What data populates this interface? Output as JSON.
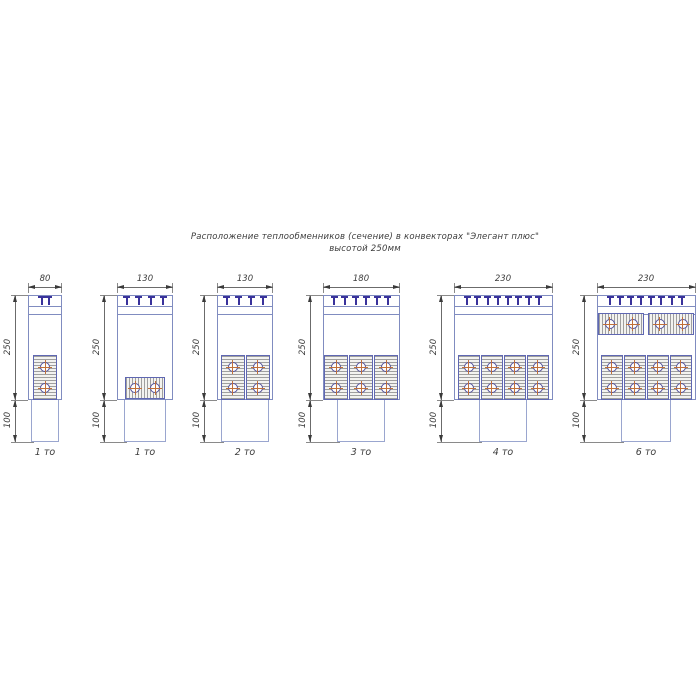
{
  "title": {
    "line1": "Расположение теплообменников (сечение) в конвекторах \"Элегант плюс\"",
    "line2": "высотой 250мм"
  },
  "units": "мм",
  "colors": {
    "outline_blue": "#808cc0",
    "grille_navy": "#39329b",
    "block_border": "#5f67b2",
    "hatch_gray": "#9f9f9f",
    "tube_ring": "#53519c",
    "tube_crosshair": "#c0703a",
    "dimension_text": "#3d3d3d"
  },
  "diagrams": [
    {
      "dim_width": "80",
      "dim_height": "250",
      "dim_duct_height": "100",
      "label": "1 то",
      "grille_slats": 2,
      "heat_exchangers": {
        "bottom": {
          "count": 1,
          "orientation": "vertical",
          "tubes_per_exchanger": 2
        }
      }
    },
    {
      "dim_width": "130",
      "dim_height": "250",
      "dim_duct_height": "100",
      "label": "1 то",
      "grille_slats": 4,
      "heat_exchangers": {
        "bottom": {
          "count": 1,
          "orientation": "horizontal",
          "tubes_per_exchanger": 2
        }
      }
    },
    {
      "dim_width": "130",
      "dim_height": "250",
      "dim_duct_height": "100",
      "label": "2 то",
      "grille_slats": 4,
      "heat_exchangers": {
        "bottom": {
          "count": 2,
          "orientation": "vertical",
          "tubes_per_exchanger": 2
        }
      }
    },
    {
      "dim_width": "180",
      "dim_height": "250",
      "dim_duct_height": "100",
      "label": "3 то",
      "grille_slats": 6,
      "heat_exchangers": {
        "bottom": {
          "count": 3,
          "orientation": "vertical",
          "tubes_per_exchanger": 2
        }
      }
    },
    {
      "dim_width": "230",
      "dim_height": "250",
      "dim_duct_height": "100",
      "label": "4 то",
      "grille_slats": 8,
      "heat_exchangers": {
        "bottom": {
          "count": 4,
          "orientation": "vertical",
          "tubes_per_exchanger": 2
        }
      }
    },
    {
      "dim_width": "230",
      "dim_height": "250",
      "dim_duct_height": "100",
      "label": "6 то",
      "grille_slats": 8,
      "heat_exchangers": {
        "top": {
          "count": 2,
          "orientation": "horizontal",
          "tubes_per_exchanger": 2
        },
        "bottom": {
          "count": 4,
          "orientation": "vertical",
          "tubes_per_exchanger": 2
        }
      }
    }
  ]
}
